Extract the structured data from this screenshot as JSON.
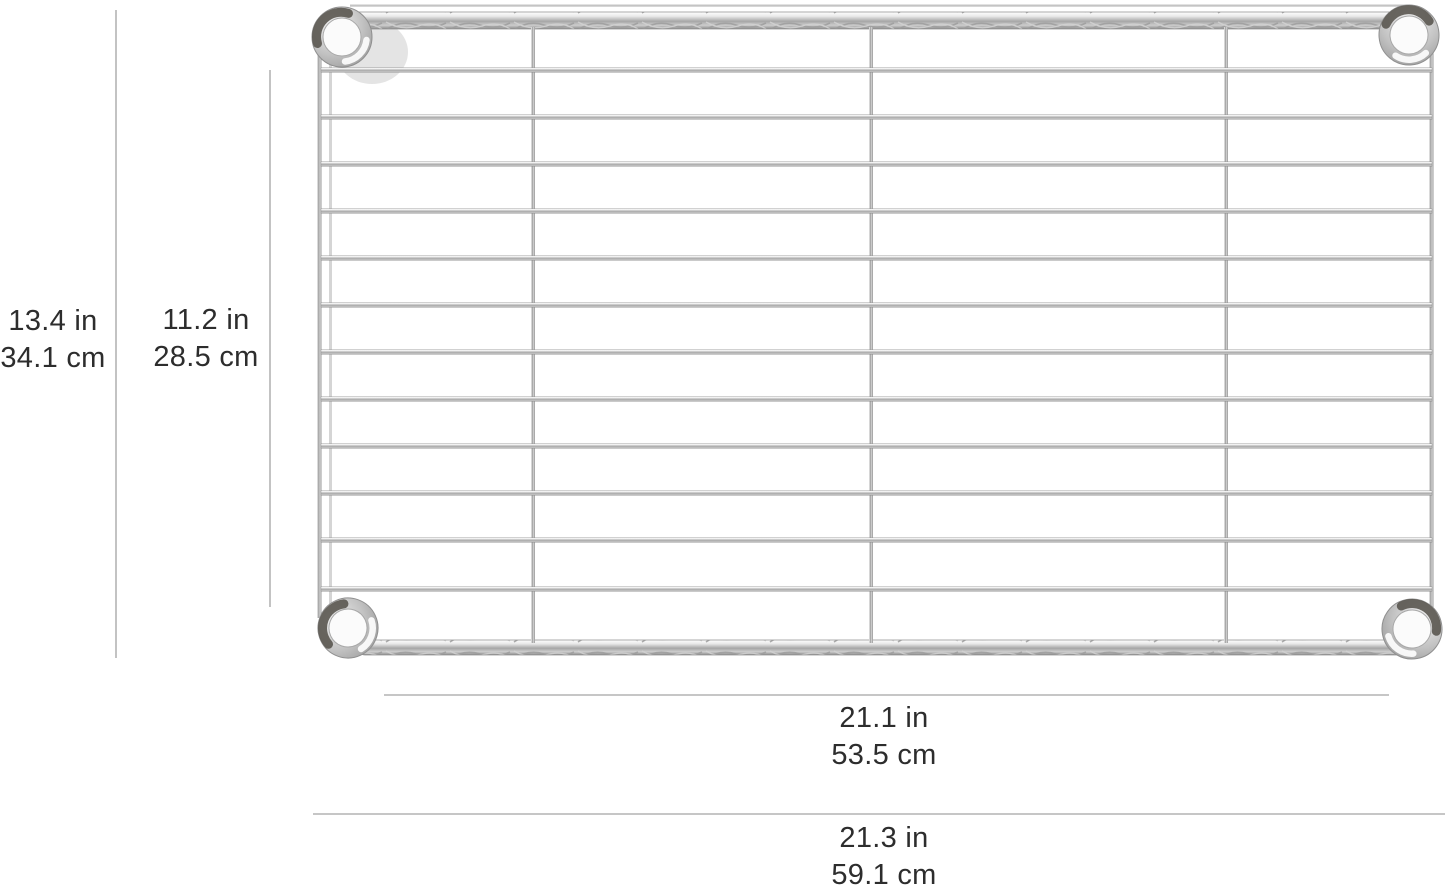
{
  "page": {
    "type": "product-dimension-diagram",
    "product_name": "chrome wire shelf panel",
    "background": "#ffffff"
  },
  "annotations": {
    "left_outer": {
      "inches": "13.4 in",
      "centimeters": "34.1 cm"
    },
    "left_inner": {
      "inches": "11.2 in",
      "centimeters": "28.5 cm"
    },
    "bottom_inner": {
      "inches": "21.1 in",
      "centimeters": "53.5 cm"
    },
    "bottom_outer": {
      "inches": "21.3 in",
      "centimeters": "59.1 cm"
    }
  },
  "colors": {
    "dimension_line": "#b4b4b4",
    "label_text": "#2d2d2d",
    "chrome_light": "#f4f4f4",
    "chrome_mid": "#b5b5b5",
    "chrome_dark": "#8c8c8c",
    "collar_dark_rim": "#57534c"
  }
}
